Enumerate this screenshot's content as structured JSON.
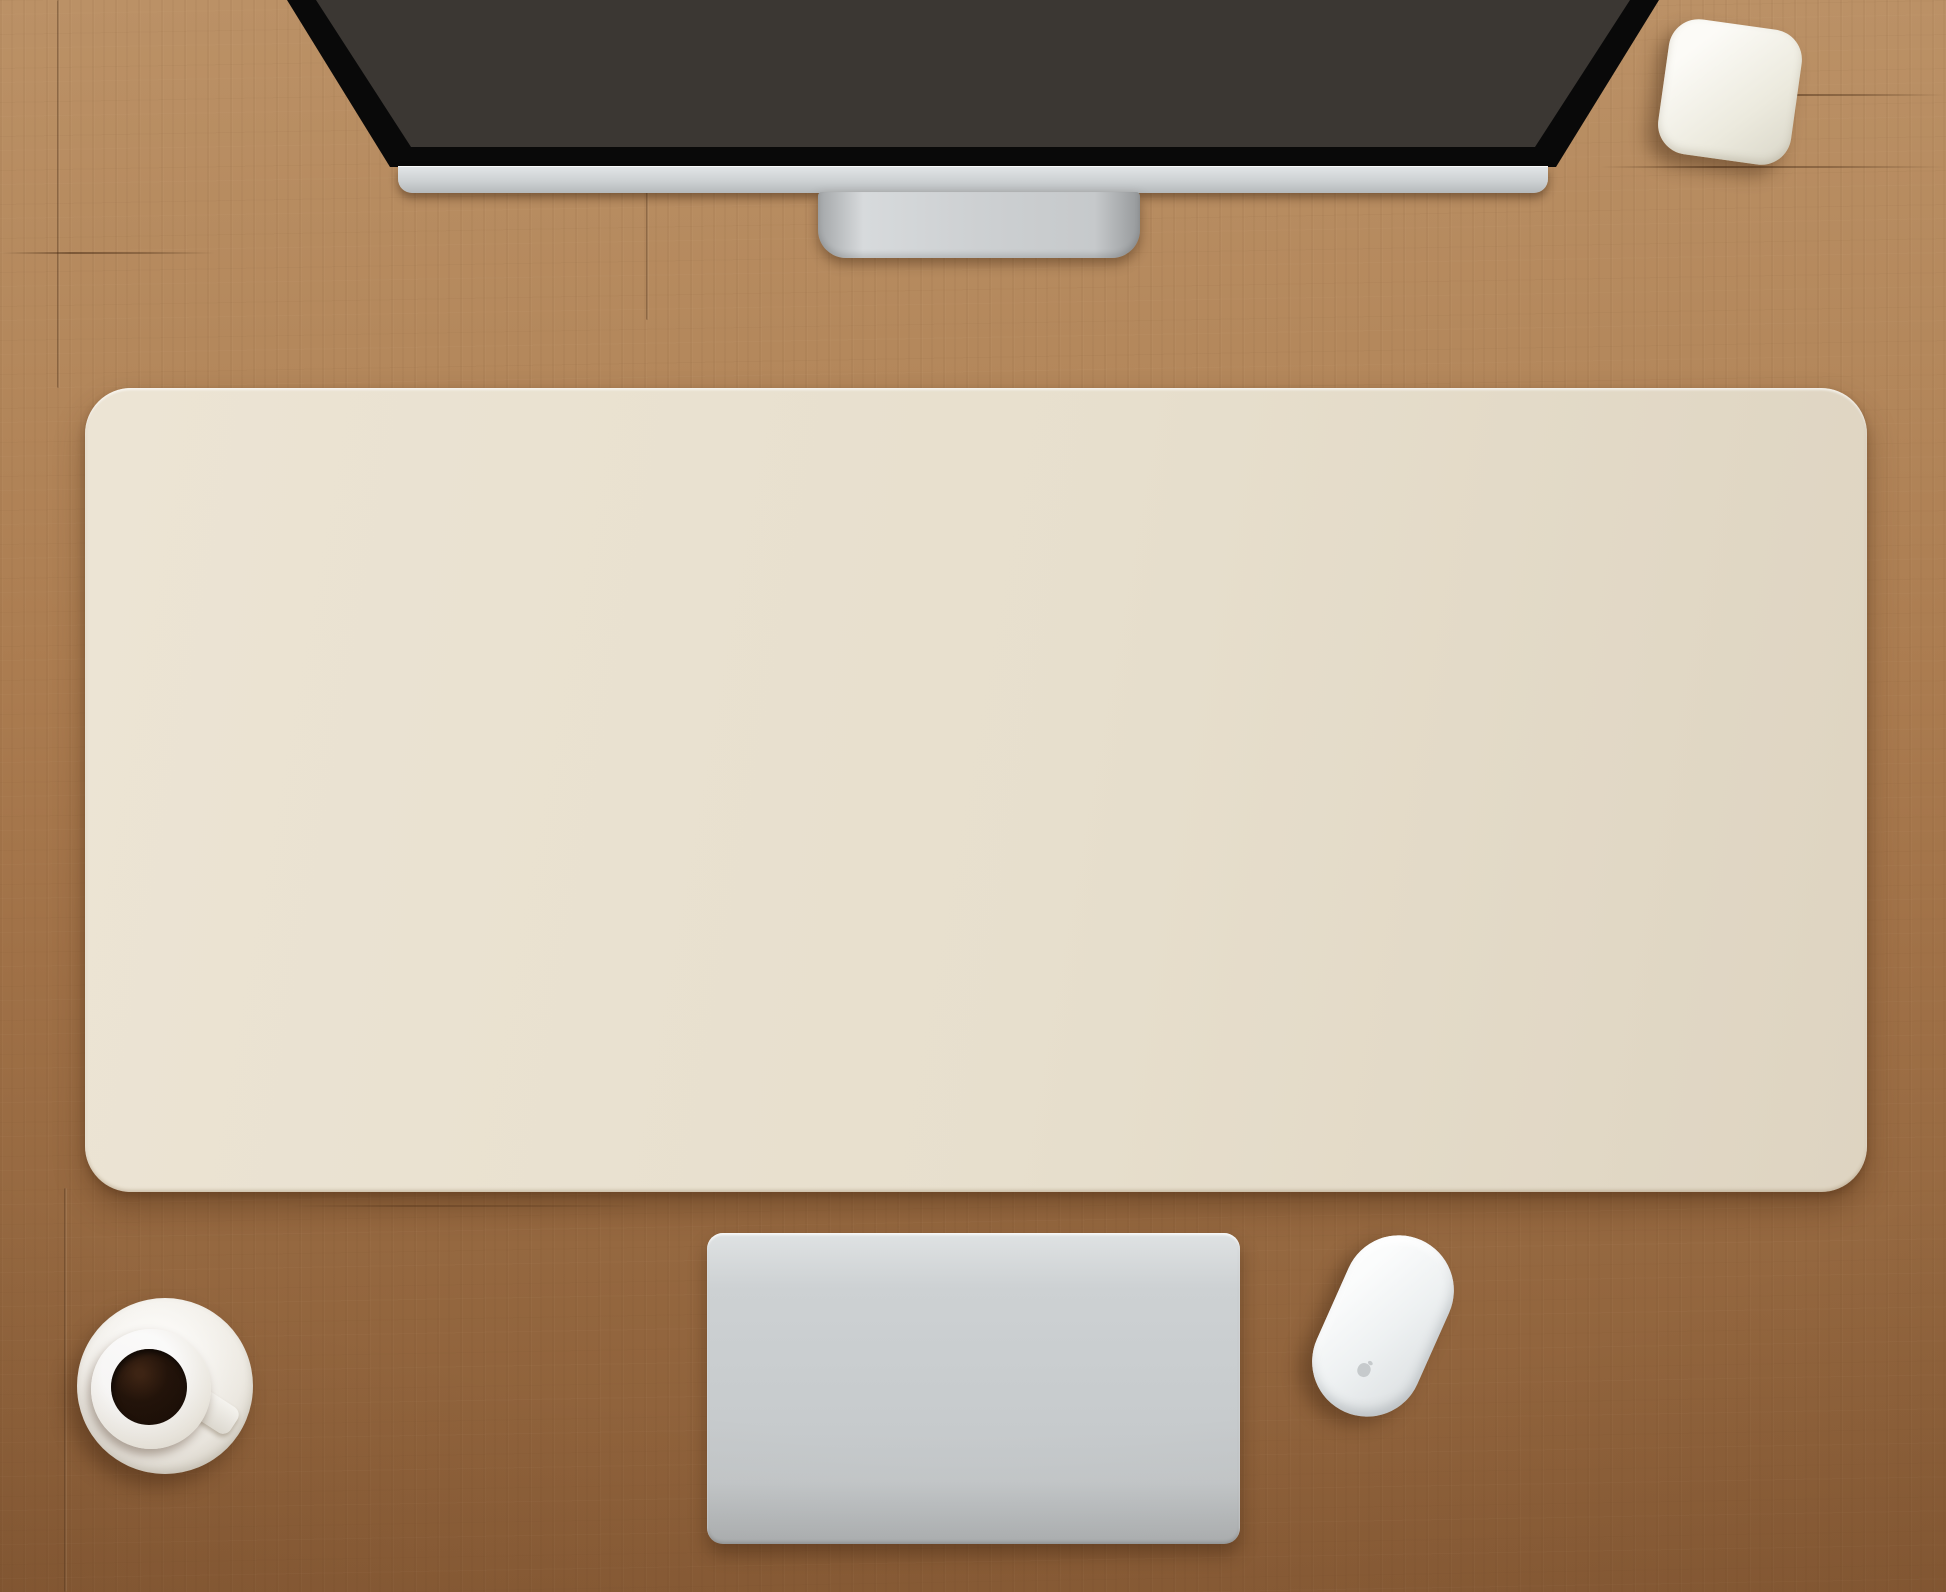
{
  "label": {
    "dimensions": "36 x 15 inch / 90 x 40 cm"
  },
  "colors": {
    "wood_light": "#bb9166",
    "wood_dark": "#8a5d37",
    "mat_bg": "#e7dfcd",
    "mat_ink": "#8f8475",
    "screen_bg": "#3b3733",
    "screen_ink": "#2d2a26",
    "keyboard_body": "#cdd1d3",
    "key_face": "#fafbfb",
    "key_text": "#94989a",
    "notebook_top": "#434b5a",
    "notebook_bottom": "#22262e",
    "coil": "#15161a",
    "leaf_outer": "#64854a",
    "leaf_mid": "#779a57",
    "leaf_inner": "#89a966",
    "leaf_center": "#97b475",
    "pot": "#f2f0ea",
    "mouse": "#eff1f2",
    "coffee": "#1a0f08",
    "saucer": "#f4f2ed",
    "wire": "#221d19",
    "label_text": "#3d3c3a"
  },
  "keyboard": {
    "arrows": [
      "◀",
      "▲",
      "▼",
      "▶"
    ],
    "rows": [
      [
        [
          "esc",
          1.3,
          "fk"
        ],
        [
          "☼",
          1,
          "fk"
        ],
        [
          "☀",
          1,
          "fk"
        ],
        [
          "▦",
          1,
          "fk"
        ],
        [
          "▤",
          1,
          "fk"
        ],
        [
          "",
          1,
          "fk"
        ],
        [
          "",
          1,
          "fk"
        ],
        [
          "◀◀",
          1,
          "fk"
        ],
        [
          "▶",
          1,
          "fk"
        ],
        [
          "▶▶",
          1,
          "fk"
        ],
        [
          "♩",
          1,
          "fk"
        ],
        [
          "♪",
          1,
          "fk"
        ],
        [
          "♫",
          1,
          "fk"
        ],
        [
          "⏏",
          1.3,
          "fk"
        ]
      ],
      [
        [
          "~\n`",
          1,
          "two"
        ],
        [
          "!\n1",
          1,
          "two"
        ],
        [
          "@\n2",
          1,
          "two"
        ],
        [
          "#\n3",
          1,
          "two"
        ],
        [
          "$\n4",
          1,
          "two"
        ],
        [
          "%\n5",
          1,
          "two"
        ],
        [
          "^\n6",
          1,
          "two"
        ],
        [
          "&\n7",
          1,
          "two"
        ],
        [
          "*\n8",
          1,
          "two"
        ],
        [
          "(\n9",
          1,
          "two"
        ],
        [
          ")\n0",
          1,
          "two"
        ],
        [
          "_\n-",
          1,
          "two"
        ],
        [
          "+\n=",
          1,
          "two"
        ],
        [
          "delete",
          1.5,
          "word"
        ]
      ],
      [
        [
          "tab",
          1.5,
          "word"
        ],
        [
          "Q",
          1,
          "letter"
        ],
        [
          "W",
          1,
          "letter"
        ],
        [
          "E",
          1,
          "letter"
        ],
        [
          "R",
          1,
          "letter"
        ],
        [
          "T",
          1,
          "letter"
        ],
        [
          "Y",
          1,
          "letter"
        ],
        [
          "U",
          1,
          "letter"
        ],
        [
          "I",
          1,
          "letter"
        ],
        [
          "O",
          1,
          "letter"
        ],
        [
          "P",
          1,
          "letter"
        ],
        [
          "{\n[",
          1,
          "two"
        ],
        [
          "}\n]",
          1,
          "two"
        ],
        [
          "|\n\\",
          1,
          "two"
        ]
      ],
      [
        [
          "caps lock",
          1.85,
          "word"
        ],
        [
          "A",
          1,
          "letter"
        ],
        [
          "S",
          1,
          "letter"
        ],
        [
          "D",
          1,
          "letter"
        ],
        [
          "F",
          1,
          "letter"
        ],
        [
          "G",
          1,
          "letter"
        ],
        [
          "H",
          1,
          "letter"
        ],
        [
          "J",
          1,
          "letter"
        ],
        [
          "K",
          1,
          "letter"
        ],
        [
          "L",
          1,
          "letter"
        ],
        [
          ":\n;",
          1,
          "two"
        ],
        [
          "\"\n'",
          1,
          "two"
        ],
        [
          "return",
          1.85,
          "word"
        ]
      ],
      [
        [
          "shift",
          2.4,
          "word"
        ],
        [
          "Z",
          1,
          "letter"
        ],
        [
          "X",
          1,
          "letter"
        ],
        [
          "C",
          1,
          "letter"
        ],
        [
          "V",
          1,
          "letter"
        ],
        [
          "B",
          1,
          "letter"
        ],
        [
          "N",
          1,
          "letter"
        ],
        [
          "M",
          1,
          "letter"
        ],
        [
          "<\n,",
          1,
          "two"
        ],
        [
          ">\n.",
          1,
          "two"
        ],
        [
          "?\n/",
          1,
          "two"
        ],
        [
          "shift",
          2.4,
          "word"
        ]
      ],
      [
        [
          "fn",
          1,
          "word"
        ],
        [
          "control",
          1.2,
          "word"
        ],
        [
          "option\n⌥",
          1.2,
          "wordsym"
        ],
        [
          "command\n⌘",
          1.5,
          "wordsym"
        ],
        [
          "",
          4.4,
          "space"
        ],
        [
          "command\n⌘",
          1.5,
          "wordsym"
        ],
        [
          "option\n⌥",
          1.2,
          "wordsym"
        ],
        [
          "ARROWS",
          2.8,
          "arrows"
        ]
      ]
    ]
  }
}
